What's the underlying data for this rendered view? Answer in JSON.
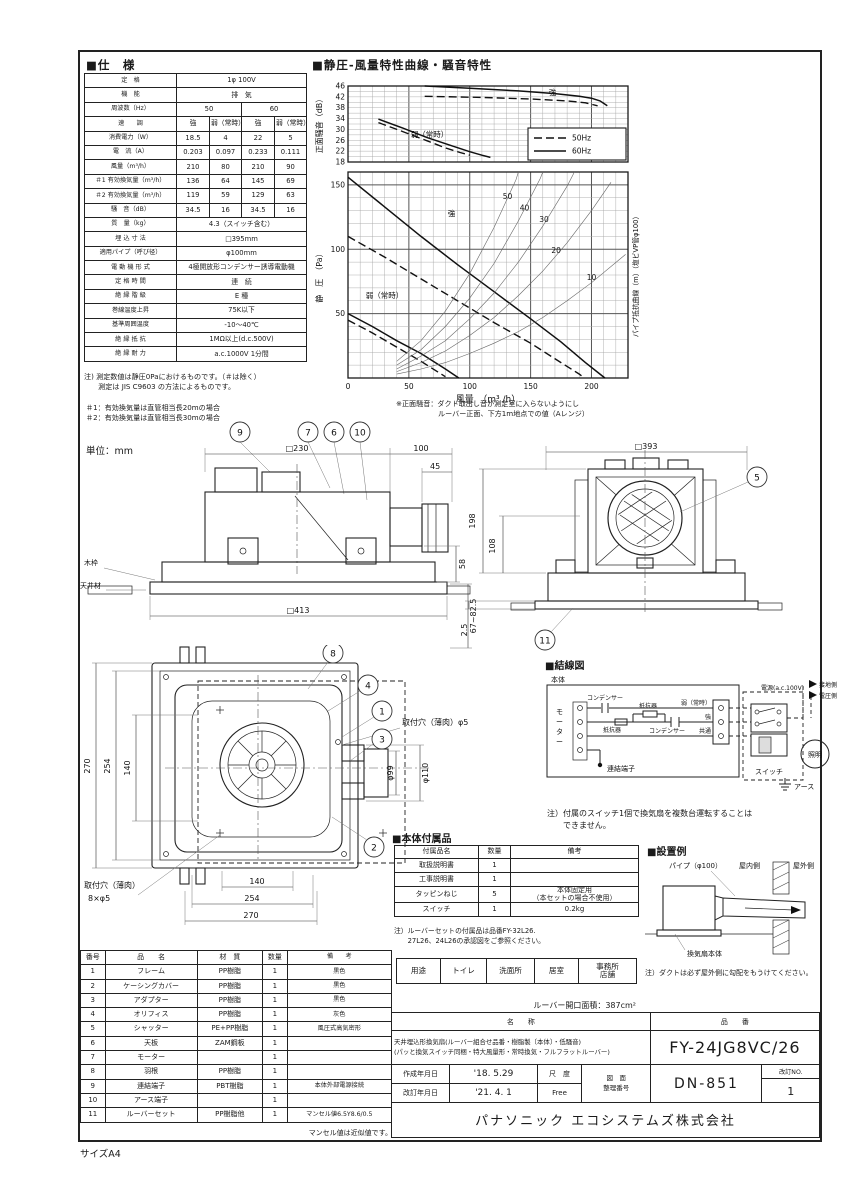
{
  "page": {
    "size_label": "サイズA4"
  },
  "spec": {
    "title": "■仕　様",
    "rows": [
      {
        "label": "定　格",
        "cells": [
          {
            "t": "1φ 100V",
            "s": 4
          }
        ]
      },
      {
        "label": "機　能",
        "cells": [
          {
            "t": "排　気",
            "s": 4
          }
        ]
      },
      {
        "label": "周波数（Hz）",
        "cells": [
          {
            "t": "50",
            "s": 2
          },
          {
            "t": "60",
            "s": 2
          }
        ]
      },
      {
        "label": "速　　調",
        "cells": [
          {
            "t": "強"
          },
          {
            "t": "弱（常時）"
          },
          {
            "t": "強"
          },
          {
            "t": "弱（常時）"
          }
        ]
      },
      {
        "label": "消費電力（W）",
        "cells": [
          {
            "t": "18.5"
          },
          {
            "t": "4"
          },
          {
            "t": "22"
          },
          {
            "t": "5"
          }
        ]
      },
      {
        "label": "電　流（A）",
        "cells": [
          {
            "t": "0.203"
          },
          {
            "t": "0.097"
          },
          {
            "t": "0.233"
          },
          {
            "t": "0.111"
          }
        ]
      },
      {
        "label": "風量（m³/h）",
        "cells": [
          {
            "t": "210"
          },
          {
            "t": "80"
          },
          {
            "t": "210"
          },
          {
            "t": "90"
          }
        ]
      },
      {
        "label": "＃1 有効換気量（m³/h）",
        "cells": [
          {
            "t": "136"
          },
          {
            "t": "64"
          },
          {
            "t": "145"
          },
          {
            "t": "69"
          }
        ]
      },
      {
        "label": "＃2 有効換気量（m³/h）",
        "cells": [
          {
            "t": "119"
          },
          {
            "t": "59"
          },
          {
            "t": "129"
          },
          {
            "t": "63"
          }
        ]
      },
      {
        "label": "騒　音（dB）",
        "cells": [
          {
            "t": "34.5"
          },
          {
            "t": "16"
          },
          {
            "t": "34.5"
          },
          {
            "t": "16"
          }
        ]
      },
      {
        "label": "質　量（kg）",
        "cells": [
          {
            "t": "4.3（スイッチ含む）",
            "s": 4
          }
        ]
      },
      {
        "label": "埋 込 寸 法",
        "cells": [
          {
            "t": "□395mm",
            "s": 4
          }
        ]
      },
      {
        "label": "適用パイプ（呼び径）",
        "cells": [
          {
            "t": "φ100mm",
            "s": 4
          }
        ]
      },
      {
        "label": "電 動 機 形 式",
        "cells": [
          {
            "t": "4極開放形コンデンサー誘導電動機",
            "s": 4
          }
        ]
      },
      {
        "label": "定 格 時 間",
        "cells": [
          {
            "t": "連　続",
            "s": 4
          }
        ]
      },
      {
        "label": "絶 縁 階 級",
        "cells": [
          {
            "t": "E 種",
            "s": 4
          }
        ]
      },
      {
        "label": "巻線温度上昇",
        "cells": [
          {
            "t": "75K以下",
            "s": 4
          }
        ]
      },
      {
        "label": "基準周囲温度",
        "cells": [
          {
            "t": "-10～40℃",
            "s": 4
          }
        ]
      },
      {
        "label": "絶 縁 抵 抗",
        "cells": [
          {
            "t": "1MΩ以上(d.c.500V)",
            "s": 4
          }
        ]
      },
      {
        "label": "絶 縁 耐 力",
        "cells": [
          {
            "t": "a.c.1000V 1分間",
            "s": 4
          }
        ]
      }
    ],
    "note1": "注) 測定数値は静圧0Paにおけるものです。（＃は除く）",
    "note2": "　　測定は JIS C9603 の方法によるものです。",
    "foot1": "＃1：有効換気量は直管相当長20mの場合",
    "foot2": "＃2：有効換気量は直管相当長30mの場合"
  },
  "chart": {
    "title": "■静圧-風量特性曲線・騒音特性",
    "ylabel_top": "正面騒音（dB）",
    "ylabel_bottom": "静　圧　（Pa）",
    "xlabel": "風量　（m³ /h）",
    "right_label": "パイプ抵抗曲線（m）（塩ビVP管φ100）",
    "note1": "※正面騒音：ダクト取出し音が測定室に入らないようにし",
    "note2": "ルーバー正面、下方1m地点での値（Aレンジ）"
  },
  "chart_data": [
    {
      "type": "line",
      "title": "騒音特性",
      "layout": {
        "plot": {
          "x": 36,
          "y": 14,
          "w": 280,
          "h": 76
        },
        "xmin": 0,
        "xmax": 230,
        "ymin": 18,
        "ymax": 46,
        "x_minor": 10,
        "x_major": 50,
        "y_minor": 2,
        "y_major": 1000,
        "y_ticks": [
          46,
          42,
          38,
          34,
          30,
          26,
          22,
          18
        ],
        "legend": {
          "x": 216,
          "y": 56,
          "w": 98,
          "h": 32
        }
      },
      "legend": [
        {
          "style": "dash",
          "label": "50Hz"
        },
        {
          "style": "solid",
          "label": "60Hz"
        }
      ],
      "series": [
        {
          "name": "強 60Hz",
          "style": "solid",
          "points": [
            [
              63,
              46
            ],
            [
              100,
              45.2
            ],
            [
              140,
              44.2
            ],
            [
              170,
              43.2
            ],
            [
              190,
              42.2
            ],
            [
              200,
              41.5
            ],
            [
              207,
              40.5
            ],
            [
              213,
              38.7
            ]
          ]
        },
        {
          "name": "強 50Hz",
          "style": "dash",
          "points": [
            [
              63,
              42.2
            ],
            [
              110,
              41.8
            ],
            [
              150,
              41.2
            ],
            [
              180,
              40.5
            ],
            [
              195,
              39.8
            ],
            [
              205,
              38.7
            ]
          ]
        },
        {
          "name": "弱（常時）60Hz",
          "style": "solid",
          "points": [
            [
              25,
              33.8
            ],
            [
              45,
              30.5
            ],
            [
              65,
              27
            ],
            [
              85,
              24
            ],
            [
              100,
              21.8
            ],
            [
              110,
              20.5
            ],
            [
              117,
              19.7
            ]
          ]
        },
        {
          "name": "弱（常時）50Hz",
          "style": "dash",
          "points": [
            [
              25,
              32.5
            ],
            [
              45,
              29.2
            ],
            [
              65,
              25.8
            ],
            [
              80,
              23.2
            ],
            [
              92,
              21.5
            ],
            [
              100,
              20.5
            ]
          ]
        }
      ],
      "annotations": [
        {
          "t": "強",
          "x": 168,
          "y": 42.6
        },
        {
          "t": "弱（常時）",
          "x": 67,
          "y": 27.2
        }
      ]
    },
    {
      "type": "line",
      "title": "静圧-風量特性曲線",
      "layout": {
        "plot": {
          "x": 36,
          "y": 100,
          "w": 280,
          "h": 206
        },
        "xmin": 0,
        "xmax": 230,
        "ymin": 0,
        "ymax": 160,
        "x_minor": 10,
        "x_major": 50,
        "y_minor": 10,
        "y_major": 50,
        "y_ticks": [
          150,
          100,
          50
        ],
        "x_ticks": [
          0,
          50,
          100,
          150,
          200
        ]
      },
      "series": [
        {
          "name": "強 60Hz",
          "style": "solid",
          "points": [
            [
              0,
              156
            ],
            [
              30,
              133
            ],
            [
              60,
              110
            ],
            [
              90,
              88
            ],
            [
              120,
              67
            ],
            [
              150,
              46
            ],
            [
              175,
              28
            ],
            [
              195,
              12
            ],
            [
              207,
              3
            ],
            [
              211,
              0
            ]
          ]
        },
        {
          "name": "強 50Hz",
          "style": "dash",
          "points": [
            [
              0,
              110
            ],
            [
              30,
              94
            ],
            [
              60,
              77
            ],
            [
              90,
              60
            ],
            [
              120,
              43
            ],
            [
              150,
              27
            ],
            [
              175,
              12
            ],
            [
              190,
              3
            ],
            [
              194,
              0
            ]
          ]
        },
        {
          "name": "弱（常時）60Hz",
          "style": "solid",
          "points": [
            [
              0,
              50
            ],
            [
              20,
              40
            ],
            [
              40,
              29
            ],
            [
              60,
              19
            ],
            [
              80,
              7
            ],
            [
              91,
              0
            ]
          ]
        },
        {
          "name": "弱（常時）50Hz",
          "style": "dash",
          "points": [
            [
              0,
              45
            ],
            [
              20,
              35
            ],
            [
              40,
              24
            ],
            [
              60,
              13
            ],
            [
              75,
              4
            ],
            [
              80,
              1
            ]
          ]
        },
        {
          "name": "パイプ抵抗50m",
          "style": "thin",
          "points": [
            [
              40,
              13
            ],
            [
              60,
              29
            ],
            [
              80,
              52
            ],
            [
              100,
              81
            ],
            [
              120,
              117
            ],
            [
              138,
              154
            ],
            [
              140,
              160
            ]
          ]
        },
        {
          "name": "パイプ抵抗40m",
          "style": "thin",
          "points": [
            [
              40,
              10
            ],
            [
              60,
              22
            ],
            [
              80,
              40
            ],
            [
              100,
              62
            ],
            [
              120,
              89
            ],
            [
              140,
              122
            ],
            [
              158,
              155
            ],
            [
              160,
              160
            ]
          ]
        },
        {
          "name": "パイプ抵抗30m",
          "style": "thin",
          "points": [
            [
              40,
              7
            ],
            [
              60,
              17
            ],
            [
              80,
              29
            ],
            [
              100,
              46
            ],
            [
              120,
              66
            ],
            [
              140,
              90
            ],
            [
              160,
              118
            ],
            [
              180,
              149
            ],
            [
              186,
              160
            ]
          ]
        },
        {
          "name": "パイプ抵抗20m",
          "style": "thin",
          "points": [
            [
              40,
              5
            ],
            [
              60,
              12
            ],
            [
              80,
              21
            ],
            [
              100,
              33
            ],
            [
              120,
              47
            ],
            [
              140,
              64
            ],
            [
              160,
              83
            ],
            [
              180,
              105
            ],
            [
              200,
              130
            ],
            [
              216,
              152
            ]
          ]
        },
        {
          "name": "パイプ抵抗10m",
          "style": "thin",
          "points": [
            [
              40,
              3
            ],
            [
              60,
              7
            ],
            [
              80,
              12
            ],
            [
              100,
              19
            ],
            [
              120,
              27
            ],
            [
              140,
              36
            ],
            [
              160,
              47
            ],
            [
              180,
              60
            ],
            [
              200,
              74
            ],
            [
              228,
              96
            ]
          ]
        }
      ],
      "annotations": [
        {
          "t": "強",
          "x": 85,
          "y": 126
        },
        {
          "t": "弱（常時）",
          "x": 30,
          "y": 62
        },
        {
          "t": "50",
          "x": 131,
          "y": 139
        },
        {
          "t": "40",
          "x": 145,
          "y": 130
        },
        {
          "t": "30",
          "x": 161,
          "y": 121
        },
        {
          "t": "20",
          "x": 171,
          "y": 97
        },
        {
          "t": "10",
          "x": 200,
          "y": 76
        }
      ]
    }
  ],
  "drawings": {
    "unit_label": "単位：mm",
    "side": {
      "dims": {
        "top_width": "□230",
        "duct_len": "100",
        "bell_len": "45",
        "drop": "58",
        "bottom_width": "□413",
        "ceiling_range": "67~82.5"
      },
      "wood_frame": "木枠",
      "ceiling": "天井材",
      "callouts": [
        "9",
        "7",
        "6",
        "10"
      ]
    },
    "front": {
      "dims": {
        "top_width": "□393",
        "height": "198",
        "inner_height": "108",
        "louver_t": "2.5"
      },
      "callouts": [
        "5",
        "11"
      ]
    },
    "plan": {
      "dims": {
        "v1": "270",
        "v2": "254",
        "v3": "140",
        "h1": "140",
        "h2": "254",
        "h3": "270",
        "pipe_inner": "φ99",
        "pipe_outer": "φ110"
      },
      "hole_right": "取付穴（薄肉）φ5",
      "hole_left1": "取付穴（薄肉）",
      "hole_left2": "8×φ5",
      "callouts": [
        "8",
        "4",
        "1",
        "3",
        "2"
      ]
    },
    "wiring": {
      "title": "■結線図",
      "body": "本体",
      "motor": [
        "モ",
        "ー",
        "タ",
        "ー"
      ],
      "capacitor1": "コンデンサー",
      "resistor1": "抵抗器",
      "capacitor2": "コンデンサー",
      "resistor2": "抵抗器",
      "weak": "弱（常時）",
      "strong": "強",
      "common": "共通",
      "terminal": "連結端子",
      "switch_label": "スイッチ",
      "lamp": "照明",
      "earth": "アース",
      "power": "電源(a.c.100V)",
      "ground_side": "接地側",
      "volt_side": "電圧側",
      "note1": "注）付属のスイッチ1個で換気扇を複数台運転することは",
      "note2": "　　できません。"
    },
    "install": {
      "title": "■設置例",
      "pipe": "パイプ（φ100）",
      "indoor": "屋内側",
      "outdoor": "屋外側",
      "body": "換気扇本体",
      "note": "注）ダクトは必ず屋外側に勾配をもうけてください。"
    }
  },
  "accessories": {
    "title": "■本体付属品",
    "headers": [
      "付属品名",
      "数量",
      "備考"
    ],
    "rows": [
      [
        "取扱説明書",
        "1",
        ""
      ],
      [
        "工事説明書",
        "1",
        ""
      ],
      [
        "タッピンねじ",
        "5",
        "本体固定用\n（本セットの場合不使用）"
      ],
      [
        "スイッチ",
        "1",
        "0.2kg"
      ]
    ],
    "note1": "注）ルーバーセットの付属品は品番FY-32L26.",
    "note2": "　　27L26、24L26の承認図をご参照ください。",
    "usage": [
      "用途",
      "トイレ",
      "洗面所",
      "居室",
      "事務所\n店舗"
    ],
    "louver_area": "ルーバー開口面積：387cm²"
  },
  "parts": {
    "headers": [
      "番号",
      "品　　名",
      "材　質",
      "数量",
      "備　　考"
    ],
    "rows": [
      [
        "1",
        "フレーム",
        "PP樹脂",
        "1",
        "黒色"
      ],
      [
        "2",
        "ケーシングカバー",
        "PP樹脂",
        "1",
        "黒色"
      ],
      [
        "3",
        "アダプター",
        "PP樹脂",
        "1",
        "黒色"
      ],
      [
        "4",
        "オリフィス",
        "PP樹脂",
        "1",
        "灰色"
      ],
      [
        "5",
        "シャッター",
        "PE+PP樹脂",
        "1",
        "風圧式高気密形"
      ],
      [
        "6",
        "天板",
        "ZAM鋼板",
        "1",
        ""
      ],
      [
        "7",
        "モーター",
        "",
        "1",
        ""
      ],
      [
        "8",
        "羽根",
        "PP樹脂",
        "1",
        ""
      ],
      [
        "9",
        "連結端子",
        "PBT樹脂",
        "1",
        "本体外部電源接続"
      ],
      [
        "10",
        "アース端子",
        "",
        "1",
        ""
      ],
      [
        "11",
        "ルーバーセット",
        "PP樹脂他",
        "1",
        "マンセル値6.5Y8.6/0.5"
      ]
    ],
    "note": "マンセル値は近似値です。"
  },
  "title_block": {
    "name_header": "名　　称",
    "pn_header": "品　　番",
    "name_line1": "天井埋込形換気扇(ルーバー組合せ品番・樹脂製〔本体〕・低騒音)",
    "name_line2": "(パッと換気スイッチ同梱・特大風量形・常時換気・フルフラットルーバー)",
    "part_number": "FY-24JG8VC/26",
    "created_label": "作成年月日",
    "created_value": "'18. 5.29",
    "revised_label": "改訂年月日",
    "revised_value": "'21. 4. 1",
    "scale_label": "尺　度",
    "scale_value": "Free",
    "ref_label1": "図　面",
    "ref_label2": "整理番号",
    "ref_number": "DN-851",
    "rev_no_label": "改訂NO.",
    "rev_no_value": "1",
    "company": "パナソニック エコシステムズ株式会社"
  }
}
